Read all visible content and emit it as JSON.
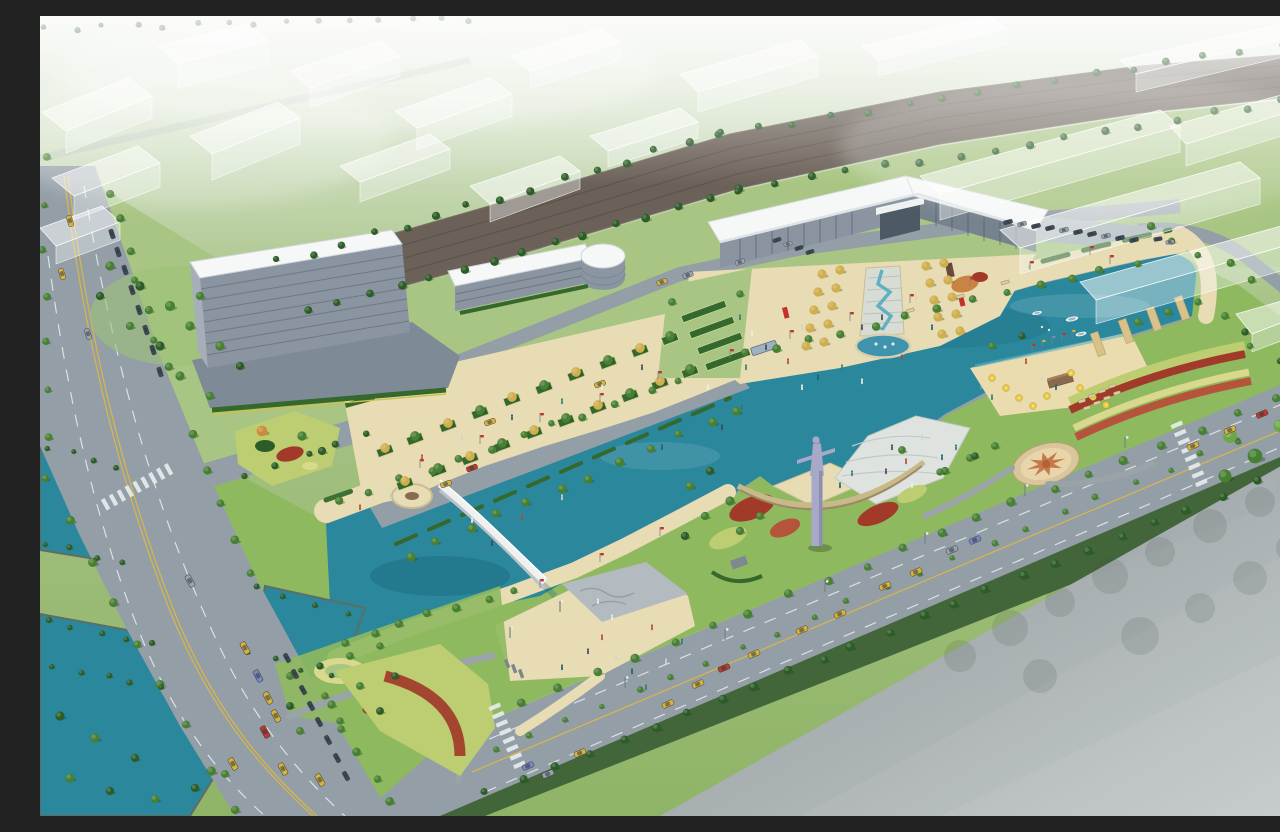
{
  "meta": {
    "alt": "Aerial architectural rendering of a riverside civic park master plan: a teal canal crossed by a white arched footbridge, a cascade fountain plaza with golden tree allees in front of an angled exhibition hall, a tall lavender monument on a sculpted south-bank plaza, tree-lined boulevards with cars, striped flower gardens, a star-patterned circular plaza, a small beach with yellow parasols and boats, and translucent white massing blocks of the surrounding city fading into haze.",
    "type": "architectural-rendering",
    "view": "aerial perspective"
  },
  "colors": {
    "water": "#2b879c",
    "waterDeep": "#1e6f85",
    "waterLight": "#5fb0c1",
    "bankWall": "#8fa0a6",
    "bankShadow": "#5d6e66",
    "road": "#939ea6",
    "roadWorn": "#a4aeb4",
    "laneWhite": "#e8edef",
    "laneYellow": "#d8b64a",
    "railBed": "#6b6158",
    "railTie": "#564f47",
    "grass": "#8fb95f",
    "grassLight": "#a9c583",
    "grassDark": "#587f3f",
    "grassDeep": "#42663a",
    "meadow": "#bccd72",
    "lawnRing": "#d8d98c",
    "canopy": "#477f33",
    "canopyDark": "#2c5c28",
    "canopyLight": "#6da647",
    "canopyGold": "#cfae4e",
    "canopyOrange": "#cd8a3c",
    "hedge": "#35682c",
    "paving": "#e7dcb4",
    "pavingDark": "#cbbd92",
    "sand": "#eadcae",
    "plazaStone": "#c3cad0",
    "reliefStone": "#b3bac0",
    "pathGray": "#9aa3a8",
    "roofWhite": "#f6f8f7",
    "fascia": "#dde3e6",
    "wallGray": "#8a95a1",
    "wallDark": "#76828e",
    "glass": "#4d5a66",
    "ghostFill": "rgba(255,255,255,0.52)",
    "ghostFace": "rgba(245,250,248,0.38)",
    "ghostEdge": "rgba(255,255,255,0.85)",
    "monument": "#a8a8c8",
    "monumentShade": "#8d8db0",
    "flowerRed": "#a23a2a",
    "flowerRust": "#b5543a",
    "flagRed": "#c43127",
    "umbrellaYellow": "#e9cb44",
    "taxiYellow": "#d9b23c",
    "carRed": "#bf3a2b",
    "carBlue": "#7a88bf",
    "carGray": "#9aa3ab",
    "carDark": "#3f4a54",
    "boatWhite": "#f2f5f4",
    "fadeA": "#8e969c",
    "fadeB": "#c3c8cb",
    "kioskBrown": "#8a6a4e",
    "dockTan": "#d8c289"
  },
  "scene": {
    "water_features": {
      "canal": "teal canal with three reaches and an east turning basin",
      "footbridges": 1,
      "road_bridges": 2,
      "boats": 3,
      "piers": 4
    },
    "structures": [
      "exhibition hall with angled white roof wings",
      "striped office slab with podium",
      "annex block with round rotunda",
      "lavender monument pylon with crossbar",
      "bus shelter",
      "beach kiosk",
      "curved monument wall"
    ],
    "landscape": [
      "cascade fountain with semicircular pool",
      "golden tree allee plaza",
      "esplanade with planting beds",
      "star-pattern circular plaza",
      "striped flower garden arcs",
      "beach with parasols and loungers",
      "riverside promenades with red flags",
      "meadow triangle with red flower crescent",
      "ghost massing blocks of city context"
    ],
    "transport": {
      "roads": "west boulevard, southeast boulevard, access road, basin loop road",
      "cars_visible": "about 60 including parked rows",
      "crosswalks": 3,
      "parking_rows": 4
    },
    "people_visible": "about 50 small figures on plazas, promenades and beach"
  }
}
